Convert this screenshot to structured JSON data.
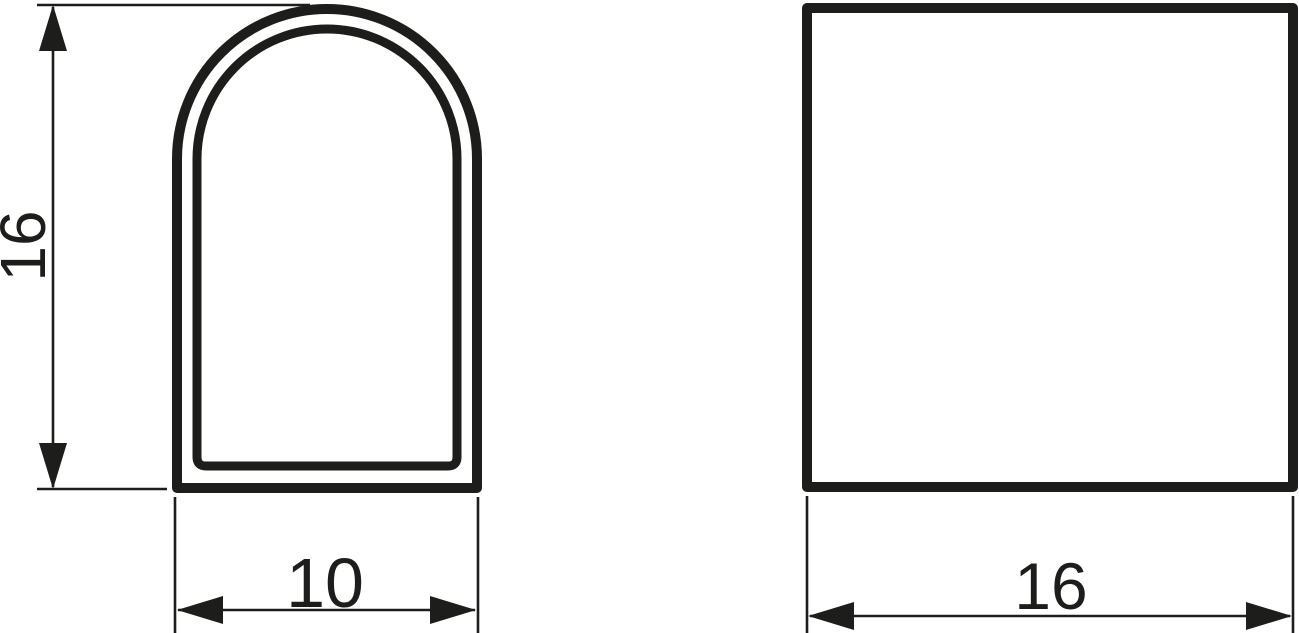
{
  "document": {
    "type": "technical-drawing",
    "background_color": "#ffffff",
    "line_color": "#1d1d1b"
  },
  "views": {
    "arch_profile": {
      "name": "arch profile front view",
      "height_dim": "16",
      "width_dim": "10"
    },
    "square_profile": {
      "name": "square side view",
      "width_dim": "16"
    }
  }
}
